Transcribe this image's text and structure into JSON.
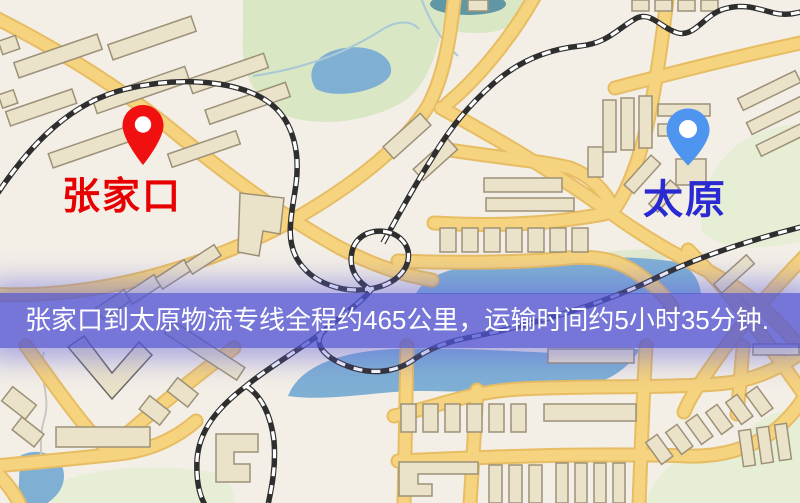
{
  "markers": {
    "origin": {
      "label": "张家口"
    },
    "destination": {
      "label": "太原"
    }
  },
  "banner": {
    "text": "张家口到太原物流专线全程约465公里，运输时间约5小时35分钟.",
    "origin": "张家口",
    "destination": "太原",
    "distance": "465公里",
    "duration": "5小时35分钟"
  },
  "map": {
    "colors": {
      "background": "#f3eee6",
      "park": "#d9e7c4",
      "park_light": "#e6eed6",
      "water": "#7fb0d4",
      "pond_teal": "#5f98a4",
      "road": "#f6d37e",
      "road_casing": "#e7bd63",
      "building_fill": "#eae2c9",
      "building_stroke": "#9d9178",
      "railway_dark": "#2e2e2e",
      "banner_overlay": "#5155d4",
      "origin_pin": "#f01010",
      "origin_text": "#e60000",
      "destination_pin": "#4e95f0",
      "destination_text": "#2a2ad2"
    }
  }
}
